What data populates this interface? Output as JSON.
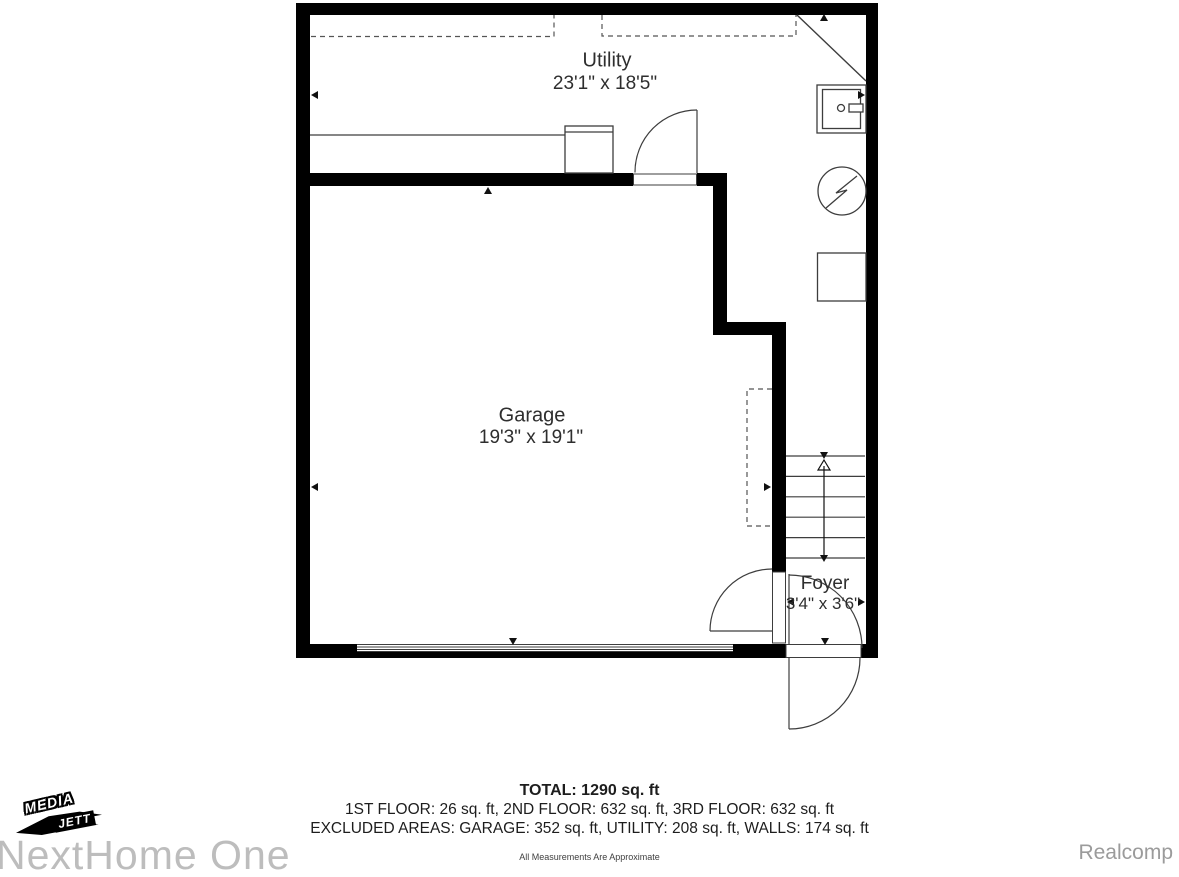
{
  "floorplan": {
    "rooms": [
      {
        "name": "Utility",
        "dims": "23'1\" x 18'5\""
      },
      {
        "name": "Garage",
        "dims": "19'3\" x 19'1\""
      },
      {
        "name": "Foyer",
        "dims": "3'4\" x 3'6\""
      }
    ]
  },
  "summary": {
    "total": "TOTAL: 1290 sq. ft",
    "floors": "1ST FLOOR: 26 sq. ft, 2ND FLOOR: 632 sq. ft, 3RD FLOOR: 632 sq. ft",
    "excluded": "EXCLUDED AREAS: GARAGE: 352 sq. ft, UTILITY: 208 sq. ft, WALLS: 174 sq. ft",
    "disclaimer": "All Measurements Are Approximate"
  },
  "branding": {
    "logo_media": "MEDIA",
    "logo_jett": "JETT",
    "watermark": "NextHome One",
    "provider": "Realcomp"
  },
  "colors": {
    "wall": "#000000",
    "line": "#3d3d3d",
    "dash": "#555555",
    "text": "#2e2e2e",
    "watermark_gray": "#bdbdbd",
    "provider_gray": "#9b9b9b"
  }
}
